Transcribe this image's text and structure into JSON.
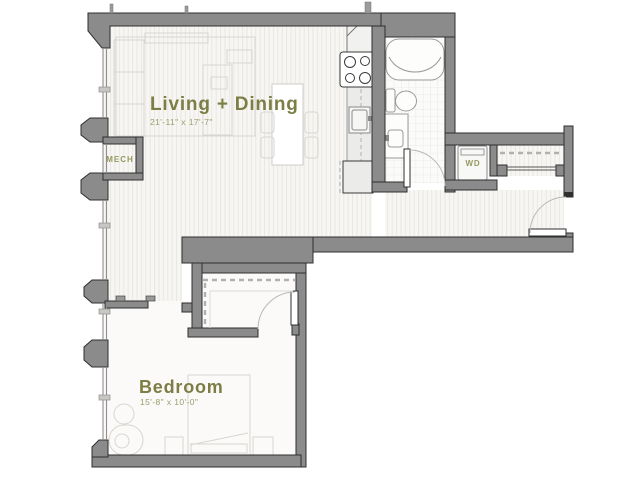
{
  "title": "Apartment floor plan",
  "rooms": {
    "living_dining": {
      "label": "Living + Dining",
      "dimensions": "21'-11\" x 17'-7\""
    },
    "bedroom": {
      "label": "Bedroom",
      "dimensions": "15'-8\" x 10'-0\""
    },
    "mech": {
      "label": "MECH"
    },
    "laundry": {
      "label": "WD"
    }
  },
  "colors": {
    "wall_fill": "#8b8b8b",
    "wall_outline": "#2f2f2f",
    "room_label": "#7c7e45",
    "dimension_label": "#9b9d6b",
    "furniture_line": "#d9d6d1",
    "fixture_line": "#9a9a9a",
    "floor_stripe": "#e9e7e3",
    "floor_base": "#f7f6f3"
  }
}
